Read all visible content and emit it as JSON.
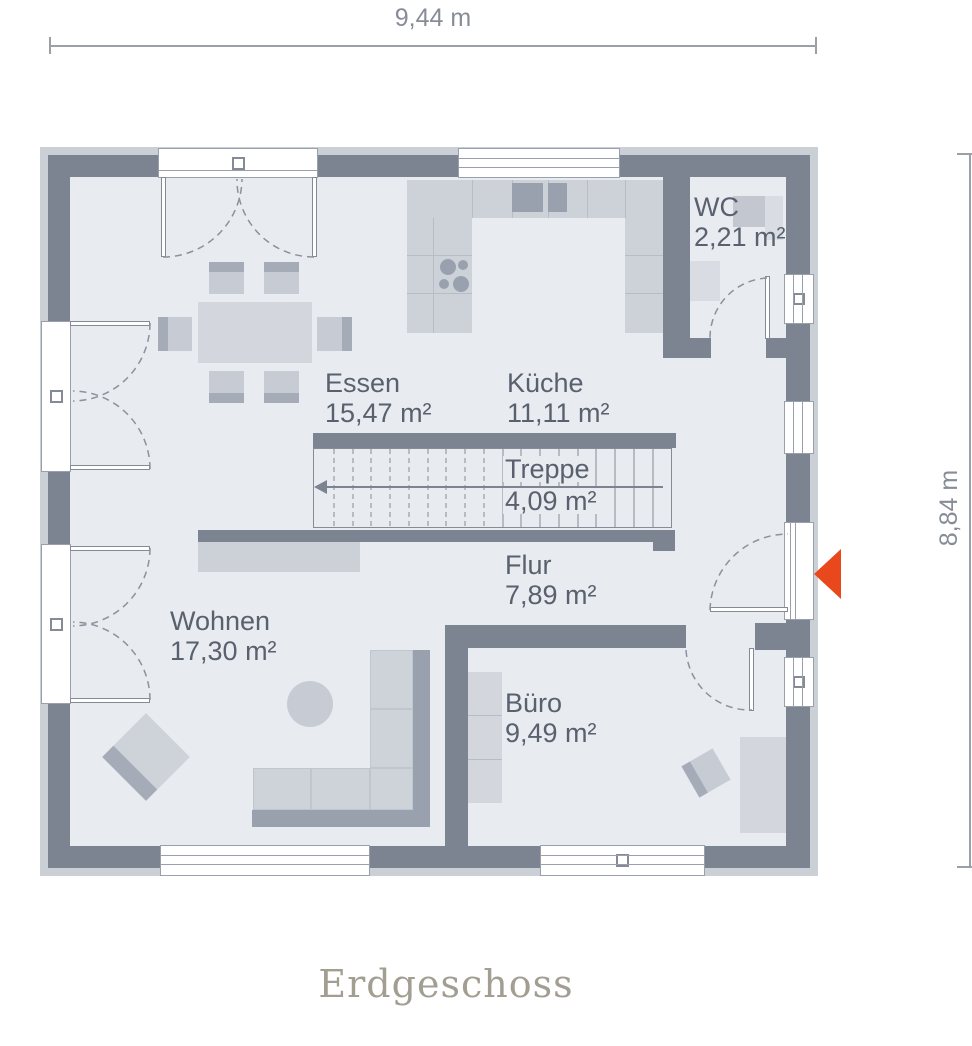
{
  "title": "Erdgeschoss",
  "dimensions": {
    "width_label": "9,44 m",
    "height_label": "8,84 m"
  },
  "rooms": [
    {
      "name": "Essen",
      "area": "15,47 m²"
    },
    {
      "name": "Küche",
      "area": "11,11 m²"
    },
    {
      "name": "WC",
      "area": "2,21 m²"
    },
    {
      "name": "Treppe",
      "area": "4,09 m²"
    },
    {
      "name": "Flur",
      "area": "7,89 m²"
    },
    {
      "name": "Wohnen",
      "area": "17,30 m²"
    },
    {
      "name": "Büro",
      "area": "9,49 m²"
    }
  ],
  "entrance": {
    "marker": "entrance-arrow",
    "color": "#e8481c"
  },
  "colors": {
    "wall": "#7c8491",
    "floor": "#e8ebf0",
    "trim": "#cbd0d7",
    "furniture_light": "#d3d7dd",
    "furniture_dark": "#a5acb8",
    "label_text": "#59616e",
    "dimension_text": "#878d96",
    "title_text": "#a29e92",
    "accent": "#e8481c"
  }
}
